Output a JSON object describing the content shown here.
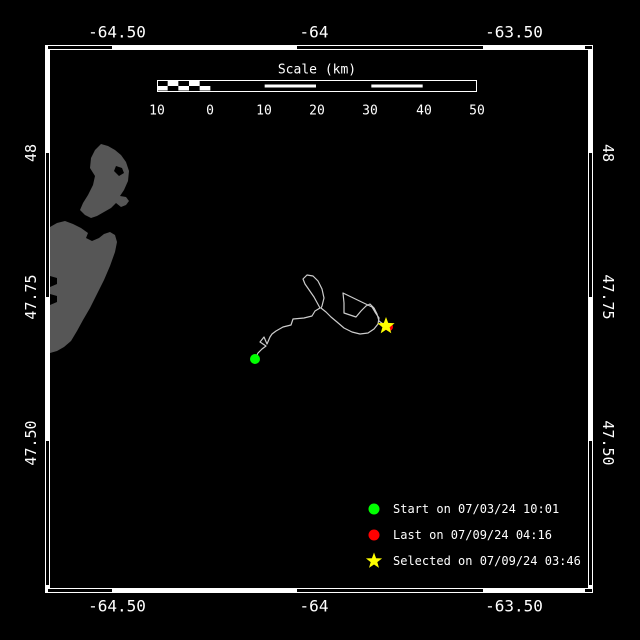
{
  "window": {
    "width": 640,
    "height": 640,
    "bg": "#000000"
  },
  "colors": {
    "frame": "#ffffff",
    "land": "#565656",
    "track": "#cccccc",
    "start": "#00ff00",
    "last": "#ff0000",
    "selected": "#ffff00",
    "text": "#ffffff"
  },
  "top_axis": {
    "ticks": [
      {
        "label": "-64.50"
      },
      {
        "label": "-64"
      },
      {
        "label": "-63.50"
      }
    ]
  },
  "bottom_axis": {
    "ticks": [
      {
        "label": "-64.50"
      },
      {
        "label": "-64"
      },
      {
        "label": "-63.50"
      }
    ]
  },
  "left_axis": {
    "ticks": [
      {
        "label": "48"
      },
      {
        "label": "47.75"
      },
      {
        "label": "47.50"
      }
    ]
  },
  "right_axis": {
    "ticks": [
      {
        "label": "48"
      },
      {
        "label": "47.75"
      },
      {
        "label": "47.50"
      }
    ]
  },
  "scale_bar": {
    "title": "Scale (km)",
    "labels": [
      "10",
      "0",
      "10",
      "20",
      "30",
      "40",
      "50"
    ],
    "geometry": {
      "x": 157,
      "y": 80,
      "w": 320,
      "h": 12,
      "checker_cells": 5,
      "sections": [
        "checker",
        "solid",
        "striped",
        "solid",
        "striped",
        "solid"
      ]
    }
  },
  "frame": {
    "x": 45,
    "y": 45,
    "w": 548,
    "h": 548,
    "zebra": {
      "top": [
        [
          48,
          112
        ],
        [
          297,
          483
        ],
        [
          585,
          592
        ]
      ],
      "bottom": [
        [
          48,
          112
        ],
        [
          297,
          483
        ],
        [
          585,
          592
        ]
      ],
      "left": [
        [
          153,
          297
        ],
        [
          441,
          585
        ]
      ],
      "right": [
        [
          153,
          297
        ],
        [
          441,
          585
        ]
      ]
    }
  },
  "map": {
    "land_px": {
      "head": [
        [
          101,
          144
        ],
        [
          108,
          146
        ],
        [
          115,
          150
        ],
        [
          121,
          155
        ],
        [
          126,
          162
        ],
        [
          129,
          171
        ],
        [
          128,
          181
        ],
        [
          124,
          190
        ],
        [
          120,
          196
        ],
        [
          126,
          197
        ],
        [
          129,
          201
        ],
        [
          126,
          205
        ],
        [
          121,
          207
        ],
        [
          116,
          203
        ],
        [
          111,
          208
        ],
        [
          104,
          212
        ],
        [
          97,
          216
        ],
        [
          91,
          218
        ],
        [
          85,
          215
        ],
        [
          80,
          210
        ],
        [
          83,
          203
        ],
        [
          88,
          195
        ],
        [
          93,
          185
        ],
        [
          95,
          176
        ],
        [
          90,
          168
        ],
        [
          91,
          158
        ],
        [
          95,
          150
        ]
      ],
      "head_hole": [
        [
          116,
          166
        ],
        [
          122,
          168
        ],
        [
          124,
          173
        ],
        [
          119,
          176
        ],
        [
          114,
          171
        ]
      ],
      "body": [
        [
          50,
          227
        ],
        [
          57,
          223
        ],
        [
          65,
          221
        ],
        [
          73,
          224
        ],
        [
          81,
          228
        ],
        [
          88,
          233
        ],
        [
          86,
          238
        ],
        [
          92,
          241
        ],
        [
          99,
          238
        ],
        [
          104,
          234
        ],
        [
          110,
          232
        ],
        [
          115,
          235
        ],
        [
          117,
          242
        ],
        [
          115,
          252
        ],
        [
          110,
          266
        ],
        [
          104,
          280
        ],
        [
          97,
          294
        ],
        [
          90,
          308
        ],
        [
          83,
          320
        ],
        [
          77,
          331
        ],
        [
          71,
          341
        ],
        [
          64,
          347
        ],
        [
          57,
          351
        ],
        [
          50,
          353
        ],
        [
          50,
          305
        ],
        [
          57,
          302
        ],
        [
          57,
          296
        ],
        [
          50,
          294
        ],
        [
          50,
          287
        ],
        [
          57,
          284
        ],
        [
          57,
          278
        ],
        [
          50,
          276
        ]
      ]
    }
  },
  "legend": {
    "items": [
      {
        "marker": "circle",
        "color": "#00ff00",
        "label": "Start on 07/03/24 10:01"
      },
      {
        "marker": "circle",
        "color": "#ff0000",
        "label": "Last on 07/09/24 04:16"
      },
      {
        "marker": "star",
        "color": "#ffff00",
        "label": "Selected on 07/09/24 03:46"
      }
    ]
  },
  "chart_data": {
    "type": "trajectory-map",
    "lon_axis": {
      "tick_labels": [
        "-64.50",
        "-64",
        "-63.50"
      ],
      "ticks": [
        -64.5,
        -64,
        -63.5
      ],
      "range": [
        -64.68,
        -63.3
      ]
    },
    "lat_axis": {
      "tick_labels": [
        "48",
        "47.75",
        "47.50"
      ],
      "ticks": [
        48,
        47.75,
        47.5
      ],
      "range": [
        48.18,
        47.24
      ]
    },
    "scale_km_labels": [
      10,
      0,
      10,
      20,
      30,
      40,
      50
    ],
    "track_px": [
      [
        255,
        359
      ],
      [
        258,
        353
      ],
      [
        262,
        349
      ],
      [
        266,
        346
      ],
      [
        260,
        342
      ],
      [
        264,
        337
      ],
      [
        267,
        344
      ],
      [
        270,
        337
      ],
      [
        272,
        334
      ],
      [
        276,
        331
      ],
      [
        283,
        327
      ],
      [
        291,
        325
      ],
      [
        293,
        319
      ],
      [
        304,
        318
      ],
      [
        312,
        316
      ],
      [
        315,
        311
      ],
      [
        320,
        308
      ],
      [
        314,
        297
      ],
      [
        305,
        284
      ],
      [
        303,
        279
      ],
      [
        307,
        275
      ],
      [
        313,
        276
      ],
      [
        318,
        281
      ],
      [
        322,
        289
      ],
      [
        324,
        298
      ],
      [
        322,
        306
      ],
      [
        321,
        308
      ],
      [
        326,
        312
      ],
      [
        331,
        317
      ],
      [
        337,
        322
      ],
      [
        344,
        328
      ],
      [
        352,
        332
      ],
      [
        360,
        334
      ],
      [
        368,
        333
      ],
      [
        374,
        329
      ],
      [
        378,
        324
      ],
      [
        379,
        318
      ],
      [
        375,
        312
      ],
      [
        372,
        307
      ],
      [
        343,
        293
      ],
      [
        344,
        303
      ],
      [
        344,
        313
      ],
      [
        350,
        315
      ],
      [
        356,
        317
      ],
      [
        361,
        311
      ],
      [
        366,
        306
      ],
      [
        370,
        304
      ],
      [
        374,
        308
      ],
      [
        377,
        314
      ],
      [
        379,
        321
      ],
      [
        383,
        324
      ],
      [
        386,
        326
      ]
    ],
    "markers": [
      {
        "name": "start",
        "shape": "circle",
        "color": "#00ff00",
        "px": [
          255,
          359
        ],
        "lonlat": [
          -64.15,
          47.64
        ],
        "label": "Start on 07/03/24 10:01"
      },
      {
        "name": "last",
        "shape": "circle",
        "color": "#ff0000",
        "px": [
          389,
          327
        ],
        "lonlat": [
          -63.81,
          47.7
        ],
        "label": "Last on 07/09/24 04:16"
      },
      {
        "name": "selected",
        "shape": "star",
        "color": "#ffff00",
        "px": [
          386,
          326
        ],
        "lonlat": [
          -63.82,
          47.7
        ],
        "label": "Selected on 07/09/24 03:46"
      }
    ]
  }
}
